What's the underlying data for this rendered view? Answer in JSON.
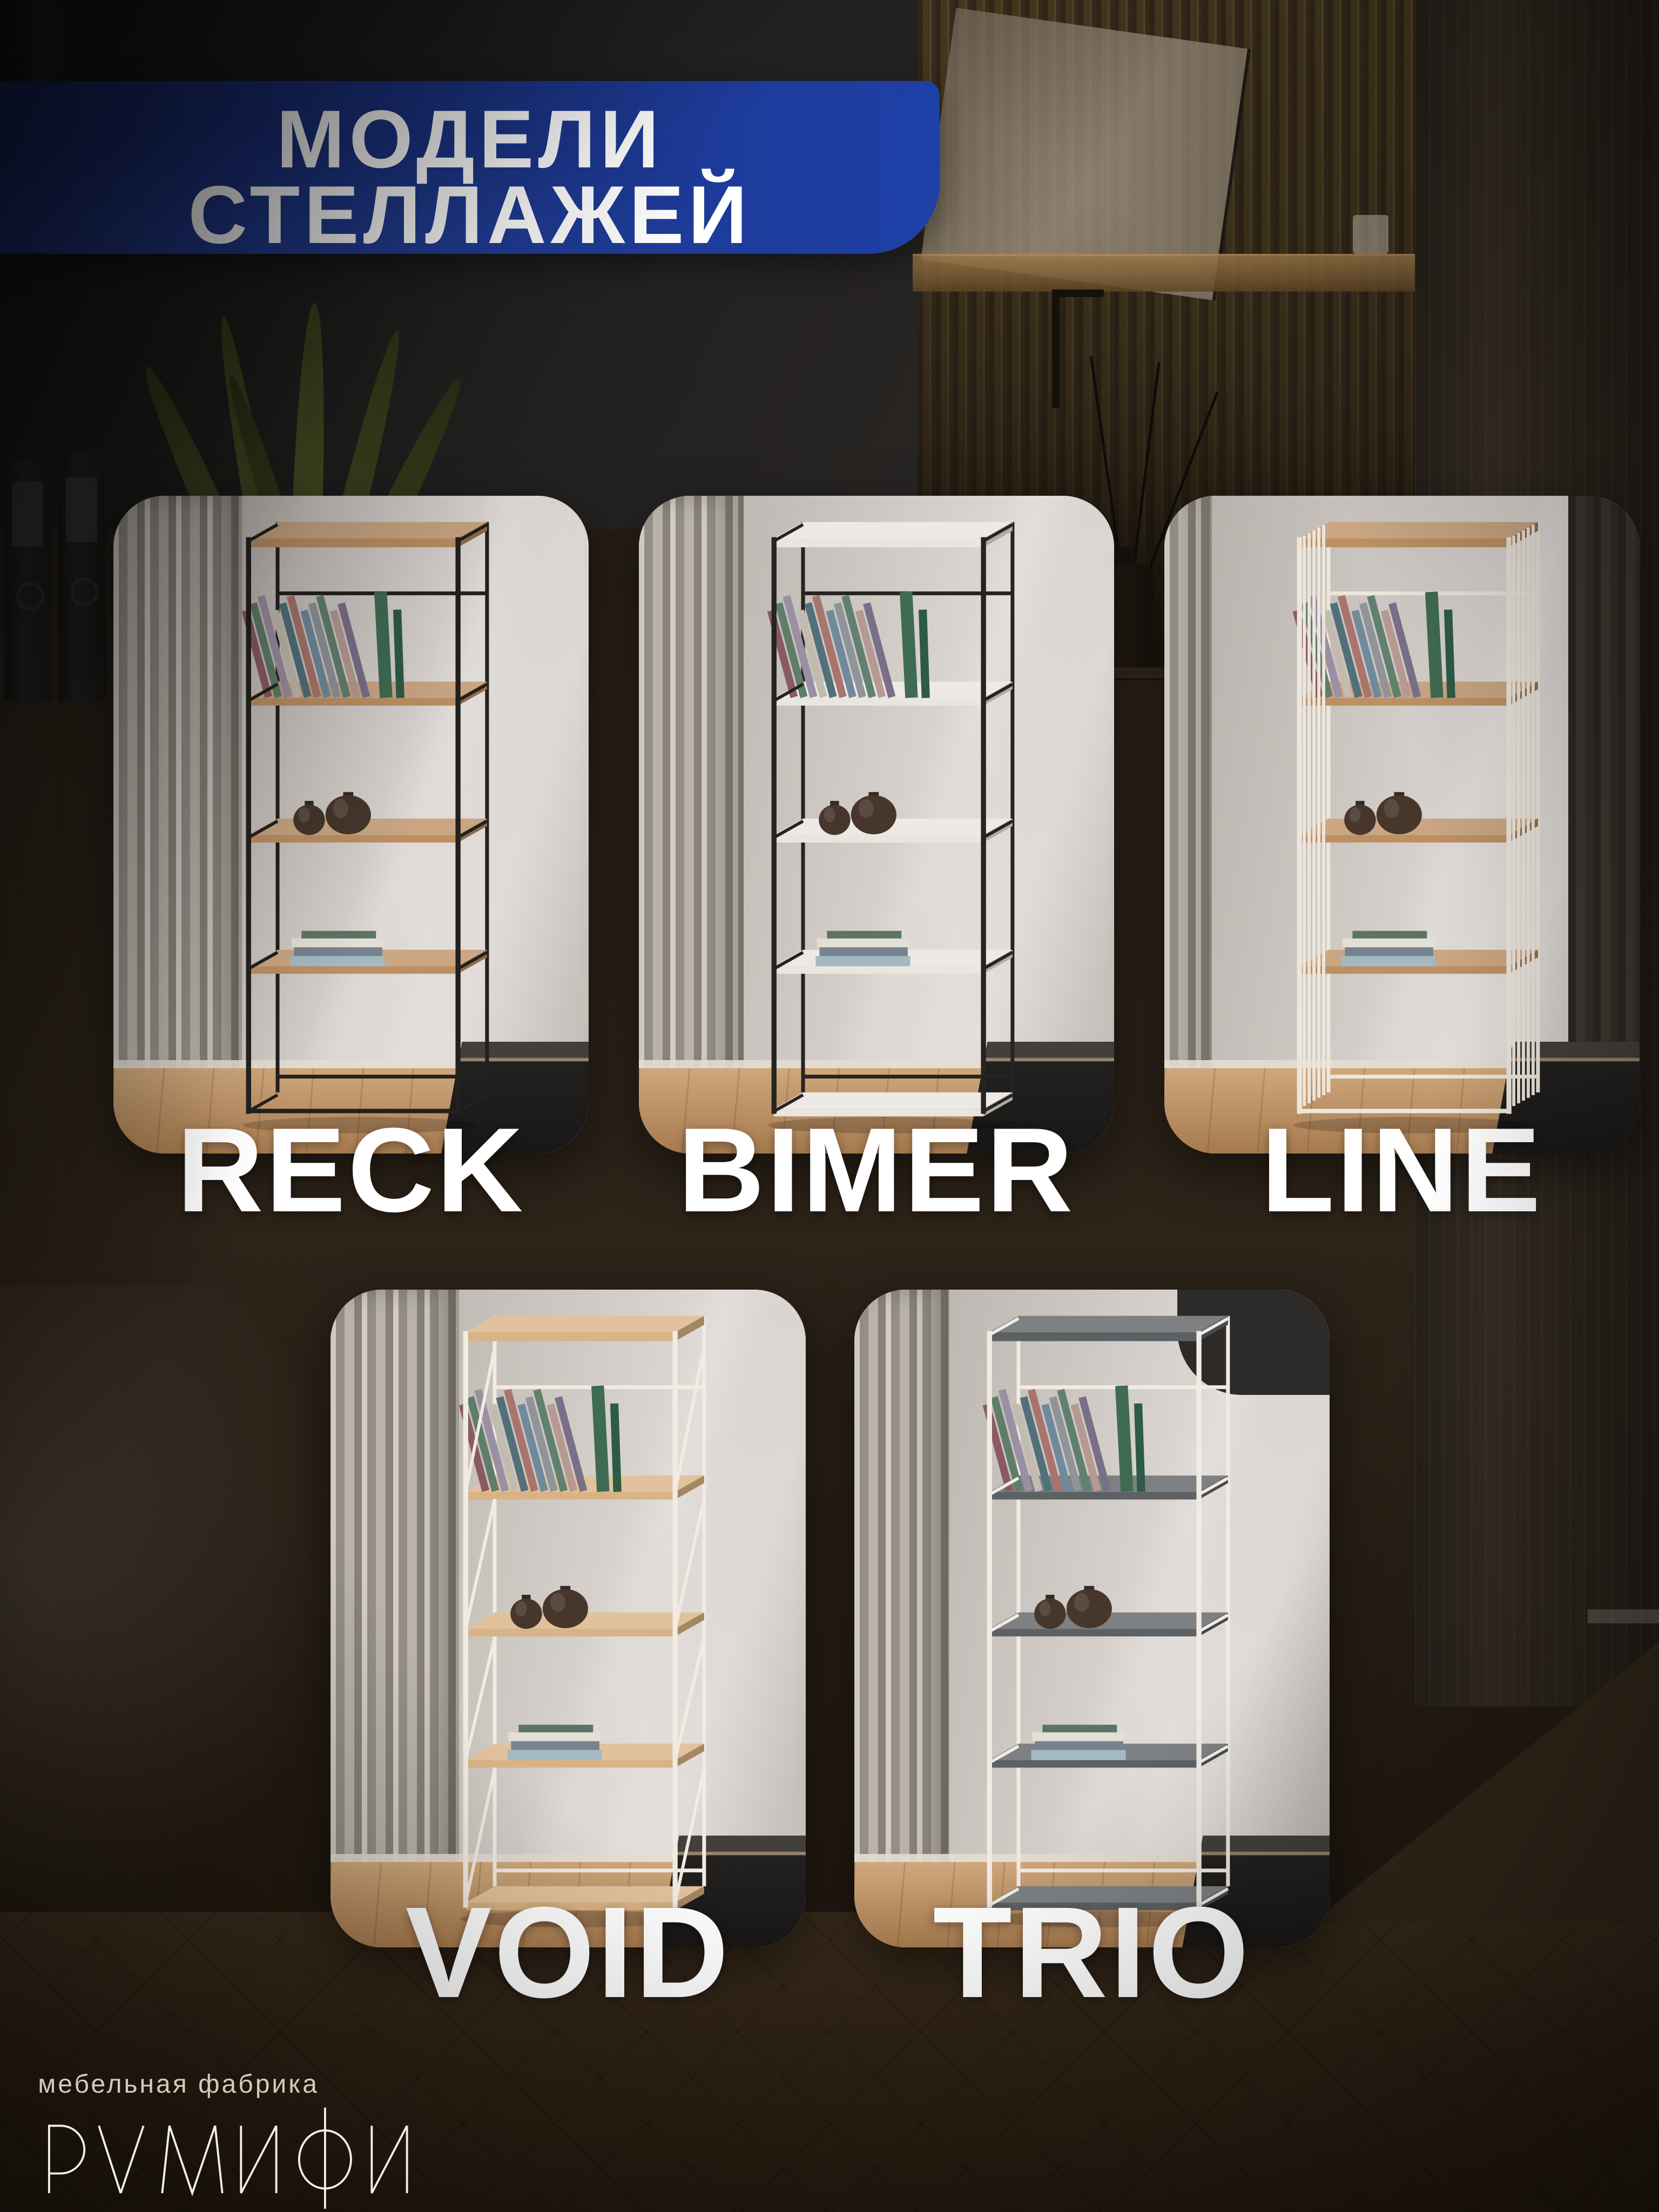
{
  "header": {
    "line1": "МОДЕЛИ",
    "line2": "СТЕЛЛАЖЕЙ"
  },
  "models": [
    {
      "name": "RECK",
      "frame_color": "#23211e",
      "shelf_color": "#bd9064",
      "side_style": "plain",
      "bottom_shelf": false
    },
    {
      "name": "BIMER",
      "frame_color": "#262420",
      "shelf_color": "#e9e5df",
      "side_style": "plain",
      "bottom_shelf": true
    },
    {
      "name": "LINE",
      "frame_color": "#ece6dc",
      "shelf_color": "#bd9064",
      "side_style": "slats",
      "bottom_shelf": false
    },
    {
      "name": "VOID",
      "frame_color": "#f1ebe2",
      "shelf_color": "#d9b383",
      "side_style": "braces",
      "bottom_shelf": true
    },
    {
      "name": "TRIO",
      "frame_color": "#f1ebe2",
      "shelf_color": "#5d6164",
      "side_style": "plain",
      "bottom_shelf": true
    }
  ],
  "footer": {
    "tagline": "мебельная фабрика",
    "brand": "РУМИФИ"
  },
  "palette": {
    "header_bg_start": "#16276a",
    "header_bg_end": "#1e40a8",
    "label_color": "#ffffff",
    "book_colors": [
      "#8a5a64",
      "#5f7d68",
      "#9b8fa3",
      "#c2bbb0",
      "#52707a",
      "#a8756e",
      "#708a9c",
      "#8f949a",
      "#62806e",
      "#b59a93",
      "#7a6f89"
    ],
    "book_upright_colors": [
      "#3f6b52",
      "#2e5b45"
    ],
    "vase_color": "#46362c",
    "stack_colors": [
      "#a3bac2",
      "#77838f",
      "#e4dfd4",
      "#5d7365"
    ]
  }
}
